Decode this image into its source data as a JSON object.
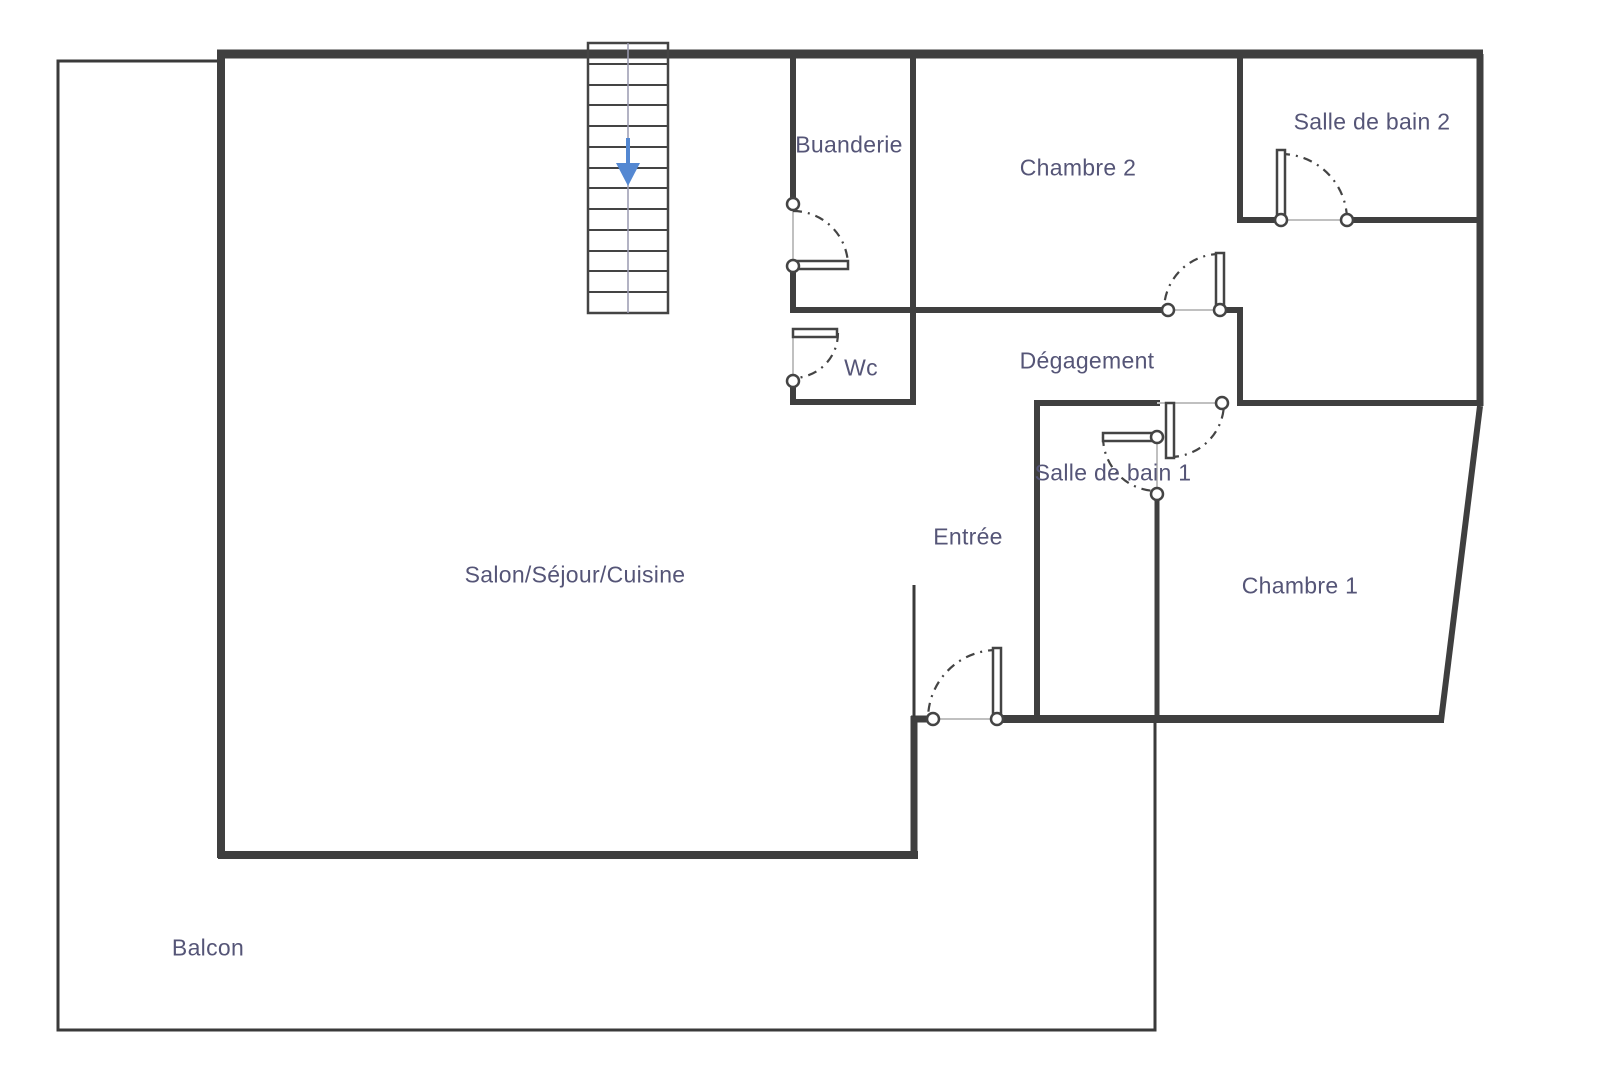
{
  "plan": {
    "type": "apartment-floor-plan",
    "rooms": [
      {
        "id": "buanderie",
        "label": "Buanderie"
      },
      {
        "id": "chambre2",
        "label": "Chambre 2"
      },
      {
        "id": "sdb2",
        "label": "Salle de bain 2"
      },
      {
        "id": "wc",
        "label": "Wc"
      },
      {
        "id": "degagement",
        "label": "Dégagement"
      },
      {
        "id": "sdb1",
        "label": "Salle de bain 1"
      },
      {
        "id": "entree",
        "label": "Entrée"
      },
      {
        "id": "salon",
        "label": "Salon/Séjour/Cuisine"
      },
      {
        "id": "chambre1",
        "label": "Chambre 1"
      },
      {
        "id": "balcon",
        "label": "Balcon"
      }
    ],
    "stairs": {
      "direction_icon": "down-arrow",
      "steps": 13
    },
    "doors": 7,
    "colors": {
      "background": "#ffffff",
      "wall": "#3f3f3f",
      "thin_line": "#3a3a3a",
      "label_text": "#555577",
      "stairs_arrow": "#5488d2",
      "door_arc": "#444444",
      "opening_line": "#c0c0c0"
    }
  }
}
